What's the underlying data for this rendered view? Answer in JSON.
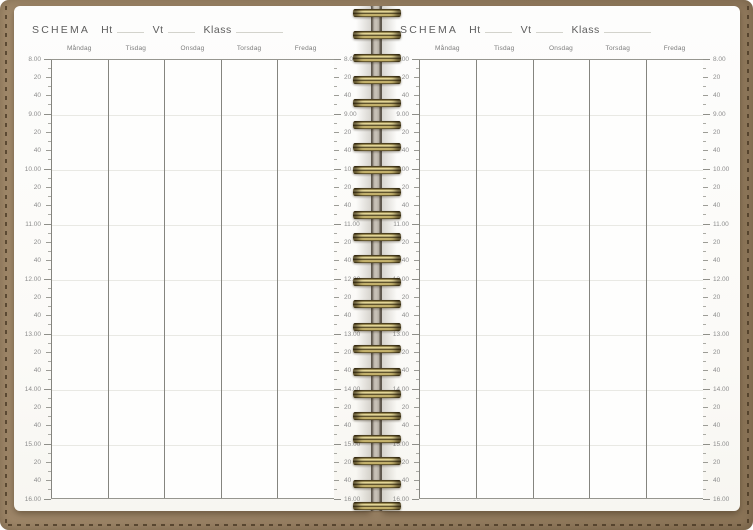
{
  "planner": {
    "title_label": "SCHEMA",
    "fields": [
      {
        "label": "Ht"
      },
      {
        "label": "Vt"
      },
      {
        "label": "Klass"
      }
    ],
    "days": [
      "Måndag",
      "Tisdag",
      "Onsdag",
      "Torsdag",
      "Fredag"
    ],
    "time_ruler": {
      "start": "8.00",
      "end": "16.00",
      "hour_labels": [
        "8.00",
        "9.00",
        "10.00",
        "11.00",
        "12.00",
        "13.00",
        "14.00",
        "15.00",
        "16.00"
      ],
      "minute_labels": [
        "20",
        "40"
      ]
    },
    "pages": [
      {
        "side": "left"
      },
      {
        "side": "right"
      }
    ],
    "colors": {
      "cover_brown": "#9c8467",
      "coil_gold": "#cdb96f",
      "page_white": "#fcfbf8",
      "column_line": "#85857f",
      "hour_line": "#e9e9e4",
      "header_text": "#5e5e5e",
      "time_text": "#8d8d8d"
    }
  }
}
